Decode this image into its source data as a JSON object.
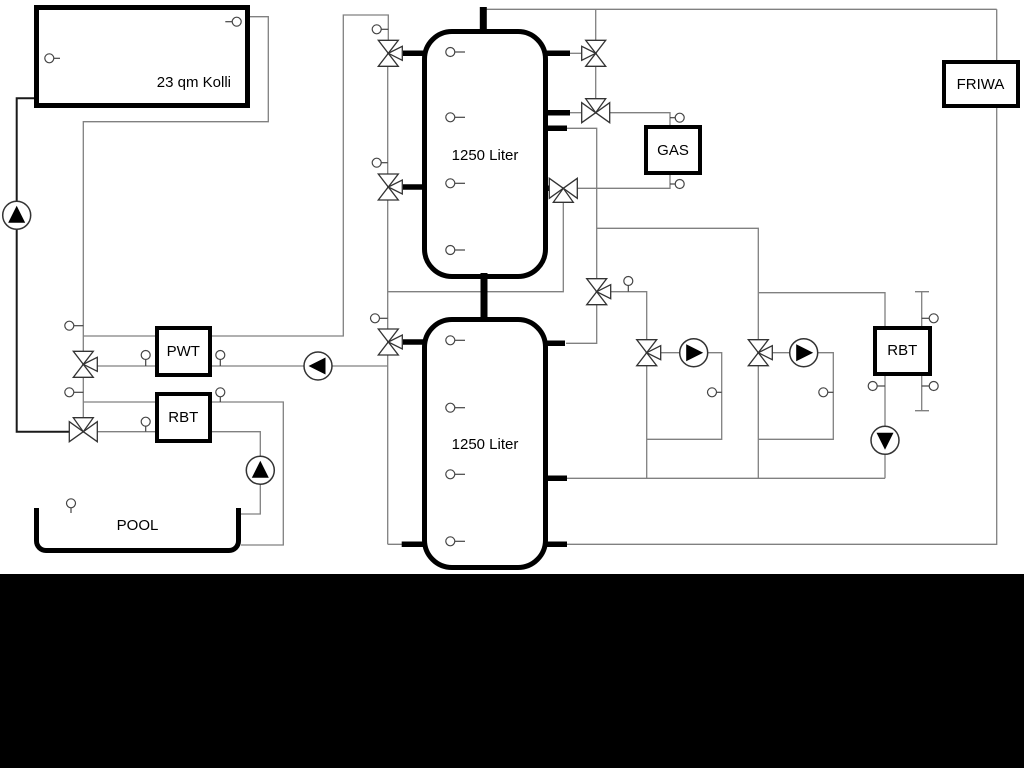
{
  "labels": {
    "collector": "23 qm Kolli",
    "tank_top": "1250 Liter",
    "tank_bottom": "1250 Liter",
    "pwt": "PWT",
    "rbt_left": "RBT",
    "rbt_right": "RBT",
    "gas": "GAS",
    "friwa": "FRIWA",
    "pool": "POOL"
  },
  "colors": {
    "background": "#ffffff",
    "pipe": "#808080",
    "solid": "#000000",
    "bottom_bar": "#000000"
  }
}
